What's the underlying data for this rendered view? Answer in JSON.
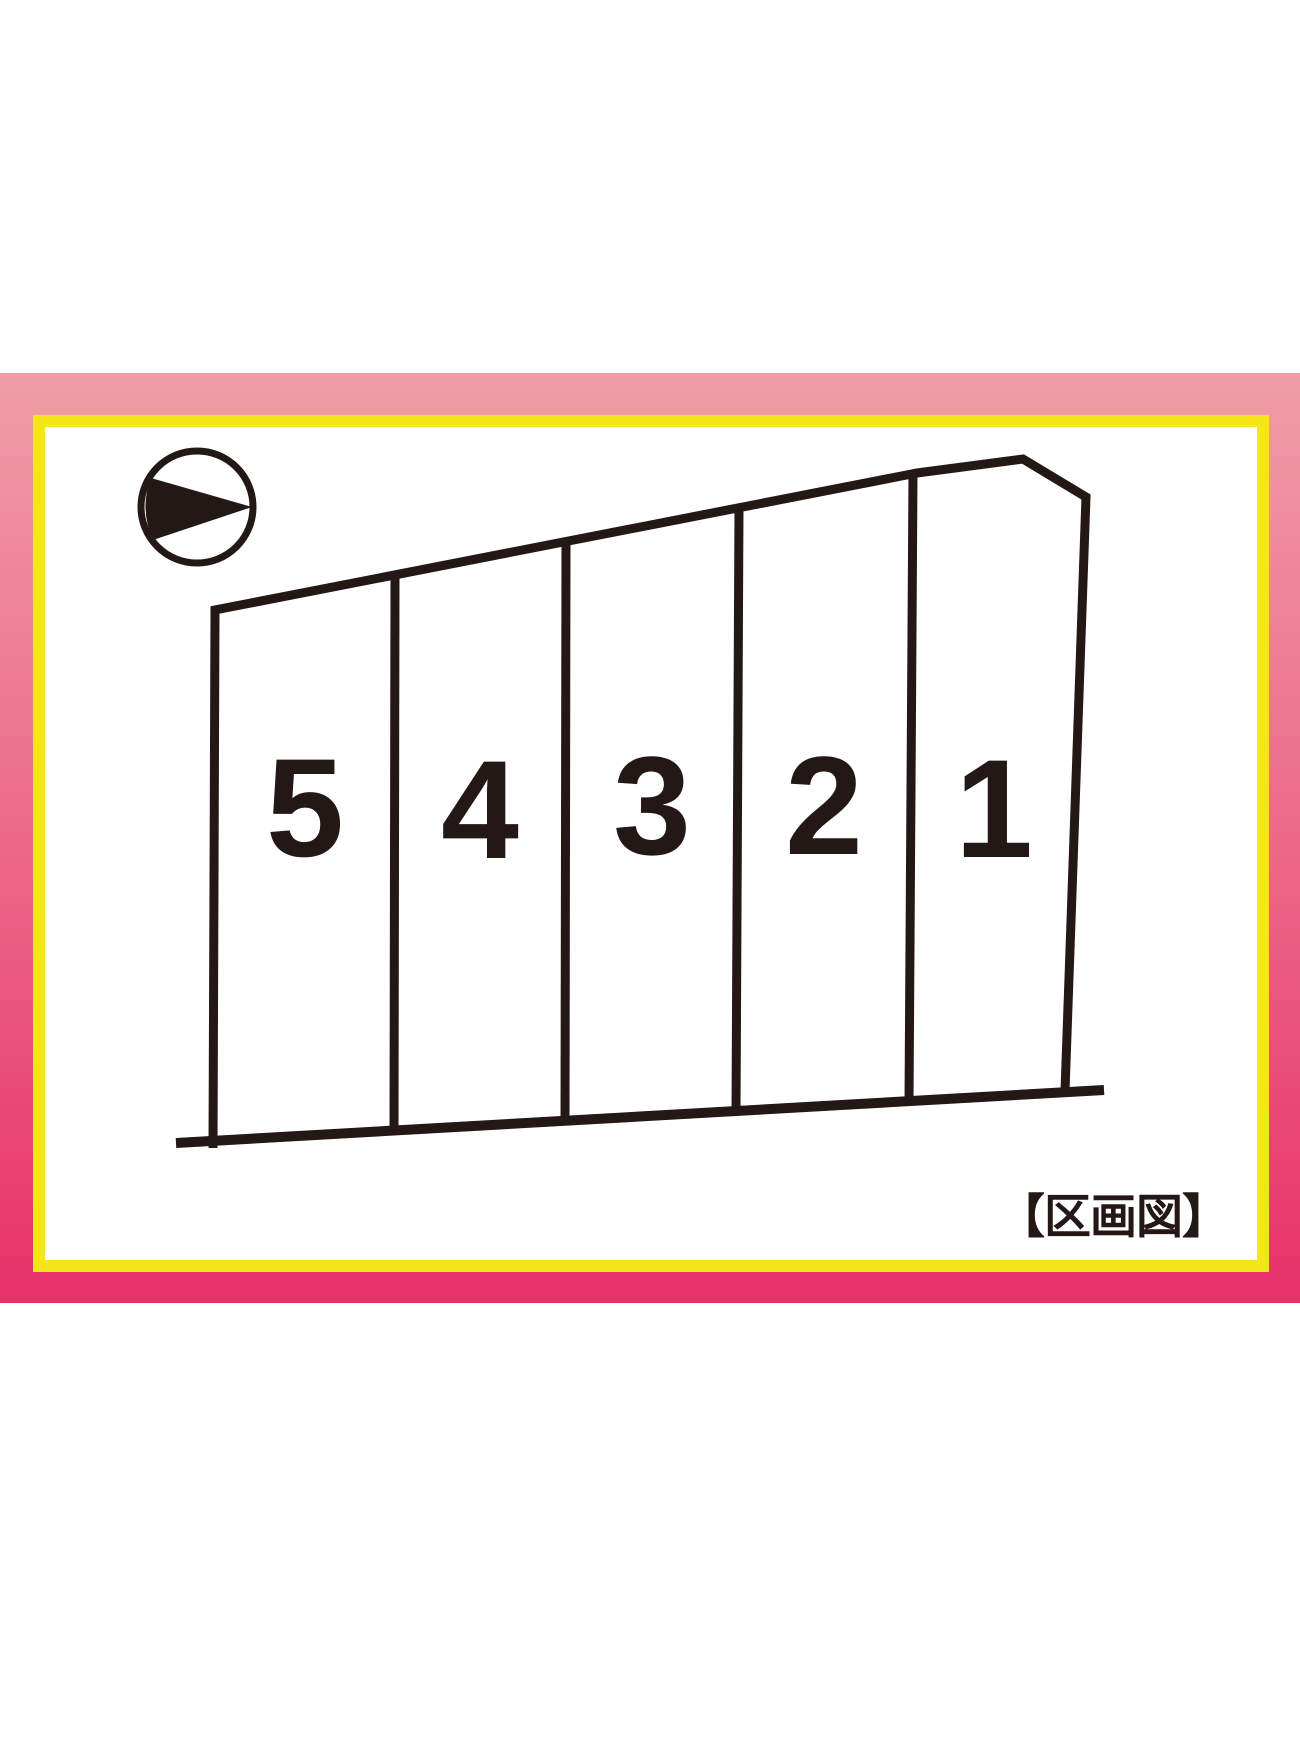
{
  "caption": {
    "text": "【区画図】",
    "meaning": "lot layout map"
  },
  "icons": {
    "compass": "north-arrow-icon",
    "compass_direction": "right"
  },
  "lots": [
    {
      "number": "5"
    },
    {
      "number": "4"
    },
    {
      "number": "3"
    },
    {
      "number": "2"
    },
    {
      "number": "1"
    }
  ],
  "colors": {
    "frame_pink_top": "#F09DA7",
    "frame_pink_bottom": "#E7316A",
    "frame_yellow": "#F5E619",
    "line": "#231815",
    "background": "#FFFFFF"
  }
}
